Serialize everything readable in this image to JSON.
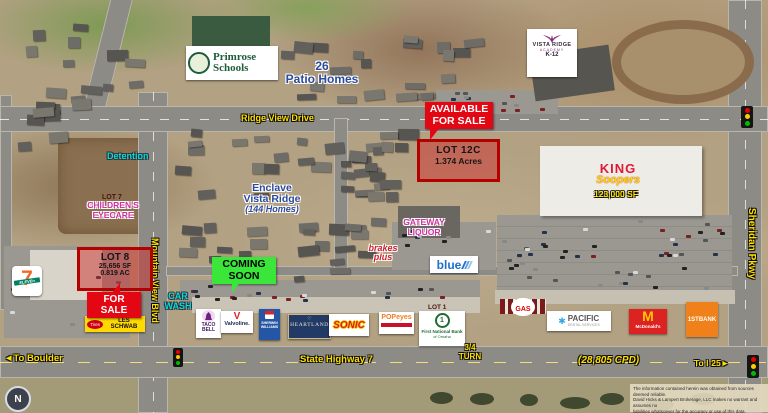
{
  "colors": {
    "sale_red": "#e30613",
    "coming_green": "#39e639",
    "street_yellow": "#ffe000",
    "area_blue": "#2b4a9b",
    "aqua": "#00dce8",
    "magenta": "#cf2fa0",
    "lot_border": "#b50000",
    "king_red": "#e31837",
    "king_yellow": "#ffd400",
    "firstbank_orange": "#f08019"
  },
  "streets": {
    "ridge_view": "Ridge View Drive",
    "mountain_view": "Mountain View Blvd",
    "sheridan": "Sheridan Pkwy",
    "highway": "State Highway 7",
    "to_boulder": "To Boulder",
    "to_boulder_arrow": "◄",
    "to_i25": "To I-25",
    "to_i25_arrow": "►",
    "cpd": "(28,805 CPD)",
    "turn1": "3/4",
    "turn2": "TURN"
  },
  "signs": {
    "available1": "AVAILABLE",
    "available2": "FOR SALE",
    "lot12c_title": "LOT 12C",
    "lot12c_area": "1.374 Acres",
    "for_sale": "FOR SALE",
    "lot8_title": "LOT 8",
    "lot8_sf": "25,656 SF",
    "lot8_ac": "0.819 AC",
    "coming1": "COMING",
    "coming2": "SOON",
    "lot1": "LOT 1"
  },
  "areas": {
    "patio1": "26",
    "patio2": "Patio Homes",
    "enclave1": "Enclave",
    "enclave2": "Vista Ridge",
    "enclave3": "(144 Homes)",
    "detention": "Detention",
    "car1": "CAR",
    "car2": "WASH",
    "eyecare_lot": "LOT 7",
    "eyecare1": "CHILDREN'S",
    "eyecare2": "EYECARE",
    "gateway1": "GATEWAY",
    "gateway2": "LIQUOR",
    "brakes1": "brakes",
    "brakes2": "plus"
  },
  "tenants": {
    "primrose1": "Primrose",
    "primrose2": "Schools",
    "academy_name": "VISTA RIDGE",
    "academy_sub": "ACADEMY",
    "academy_grades": "K-12",
    "king1": "KING",
    "king2": "Soopers",
    "king_size": "123,000 SF",
    "seven": "7",
    "eleven": "ELEVEn",
    "tires": "Tires",
    "les_schwab": "LES SCHWAB",
    "taco1": "TACO",
    "taco2": "BELL",
    "valvoline": "Valvoline.",
    "sherwin1": "SHERWIN",
    "sherwin2": "WILLIAMS",
    "heartland": "HEARTLAND",
    "sonic": "SONIC",
    "popeyes": "POPeyes",
    "fnb_one": "1",
    "fnb1": "First National Bank",
    "fnb2": "of Omaha",
    "gas": "GAS",
    "pacific1": "PACIFIC",
    "pacific2": "DENTAL SERVICES",
    "mcd_m": "M",
    "mcd_name": "McDonald's",
    "firstbank": "1STBANK",
    "blue": "blue"
  },
  "misc": {
    "compass": "N",
    "disclaimer1": "The information contained herein was obtained from sources deemed reliable.",
    "disclaimer2": "David Hicks & Lampert Brokerage, LLC makes no warrant and assumes no",
    "disclaimer3": "liabilities whatsoever for the accuracy or use of this data."
  }
}
